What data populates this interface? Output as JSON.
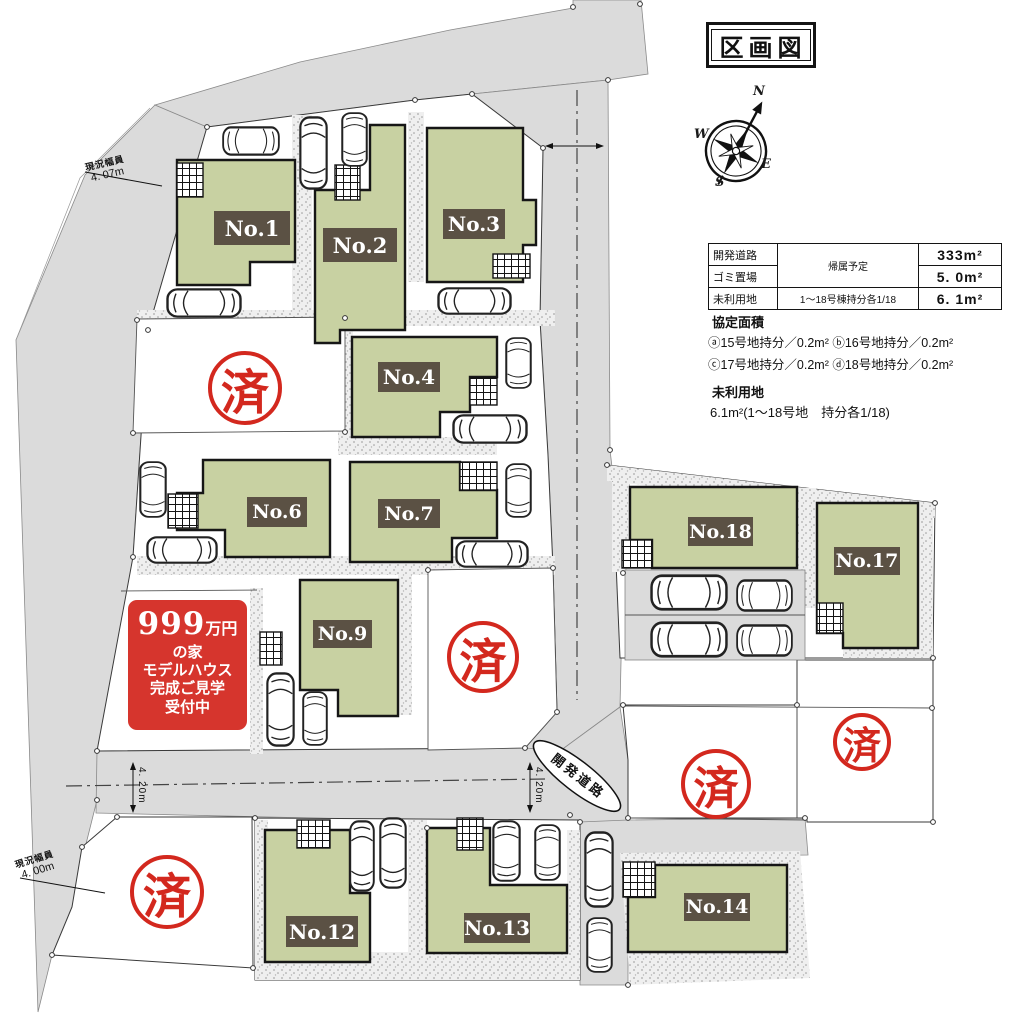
{
  "title": "区画図",
  "compass": {
    "n": "N",
    "e": "E",
    "s": "S",
    "w": "W"
  },
  "info_table": {
    "rows": [
      {
        "item": "開発道路",
        "note": "帰属予定",
        "value": "333m²"
      },
      {
        "item": "ゴミ置場",
        "note": "帰属予定",
        "value": "5. 0m²"
      },
      {
        "item": "未利用地",
        "note": "1〜18号棟持分各1/18",
        "value": "6. 1m²"
      }
    ]
  },
  "agreement": {
    "heading": "協定面積",
    "line1": "ⓐ15号地持分／0.2m² ⓑ16号地持分／0.2m²",
    "line2": "ⓒ17号地持分／0.2m² ⓓ18号地持分／0.2m²"
  },
  "unused_land": {
    "heading": "未利用地",
    "detail": "6.1m²(1〜18号地　持分各1/18)"
  },
  "promo": {
    "price": "999",
    "price_unit": "万円",
    "line2": "の家",
    "line3": "モデルハウス",
    "line4": "完成ご見学",
    "line5": "受付中"
  },
  "map": {
    "sold_stamp": "済",
    "road_label": "開発道路",
    "width_top_left": {
      "caption": "現況幅員",
      "value": "4. 07m"
    },
    "width_bottom_left": {
      "caption": "現況幅員",
      "value": "4. 00m"
    },
    "road_width": "4. 20m",
    "lots": [
      {
        "label": "No.1"
      },
      {
        "label": "No.2"
      },
      {
        "label": "No.3"
      },
      {
        "label": "No.4"
      },
      {
        "label": "No.6"
      },
      {
        "label": "No.7"
      },
      {
        "label": "No.9"
      },
      {
        "label": "No.12"
      },
      {
        "label": "No.13"
      },
      {
        "label": "No.14"
      },
      {
        "label": "No.17"
      },
      {
        "label": "No.18"
      }
    ]
  }
}
